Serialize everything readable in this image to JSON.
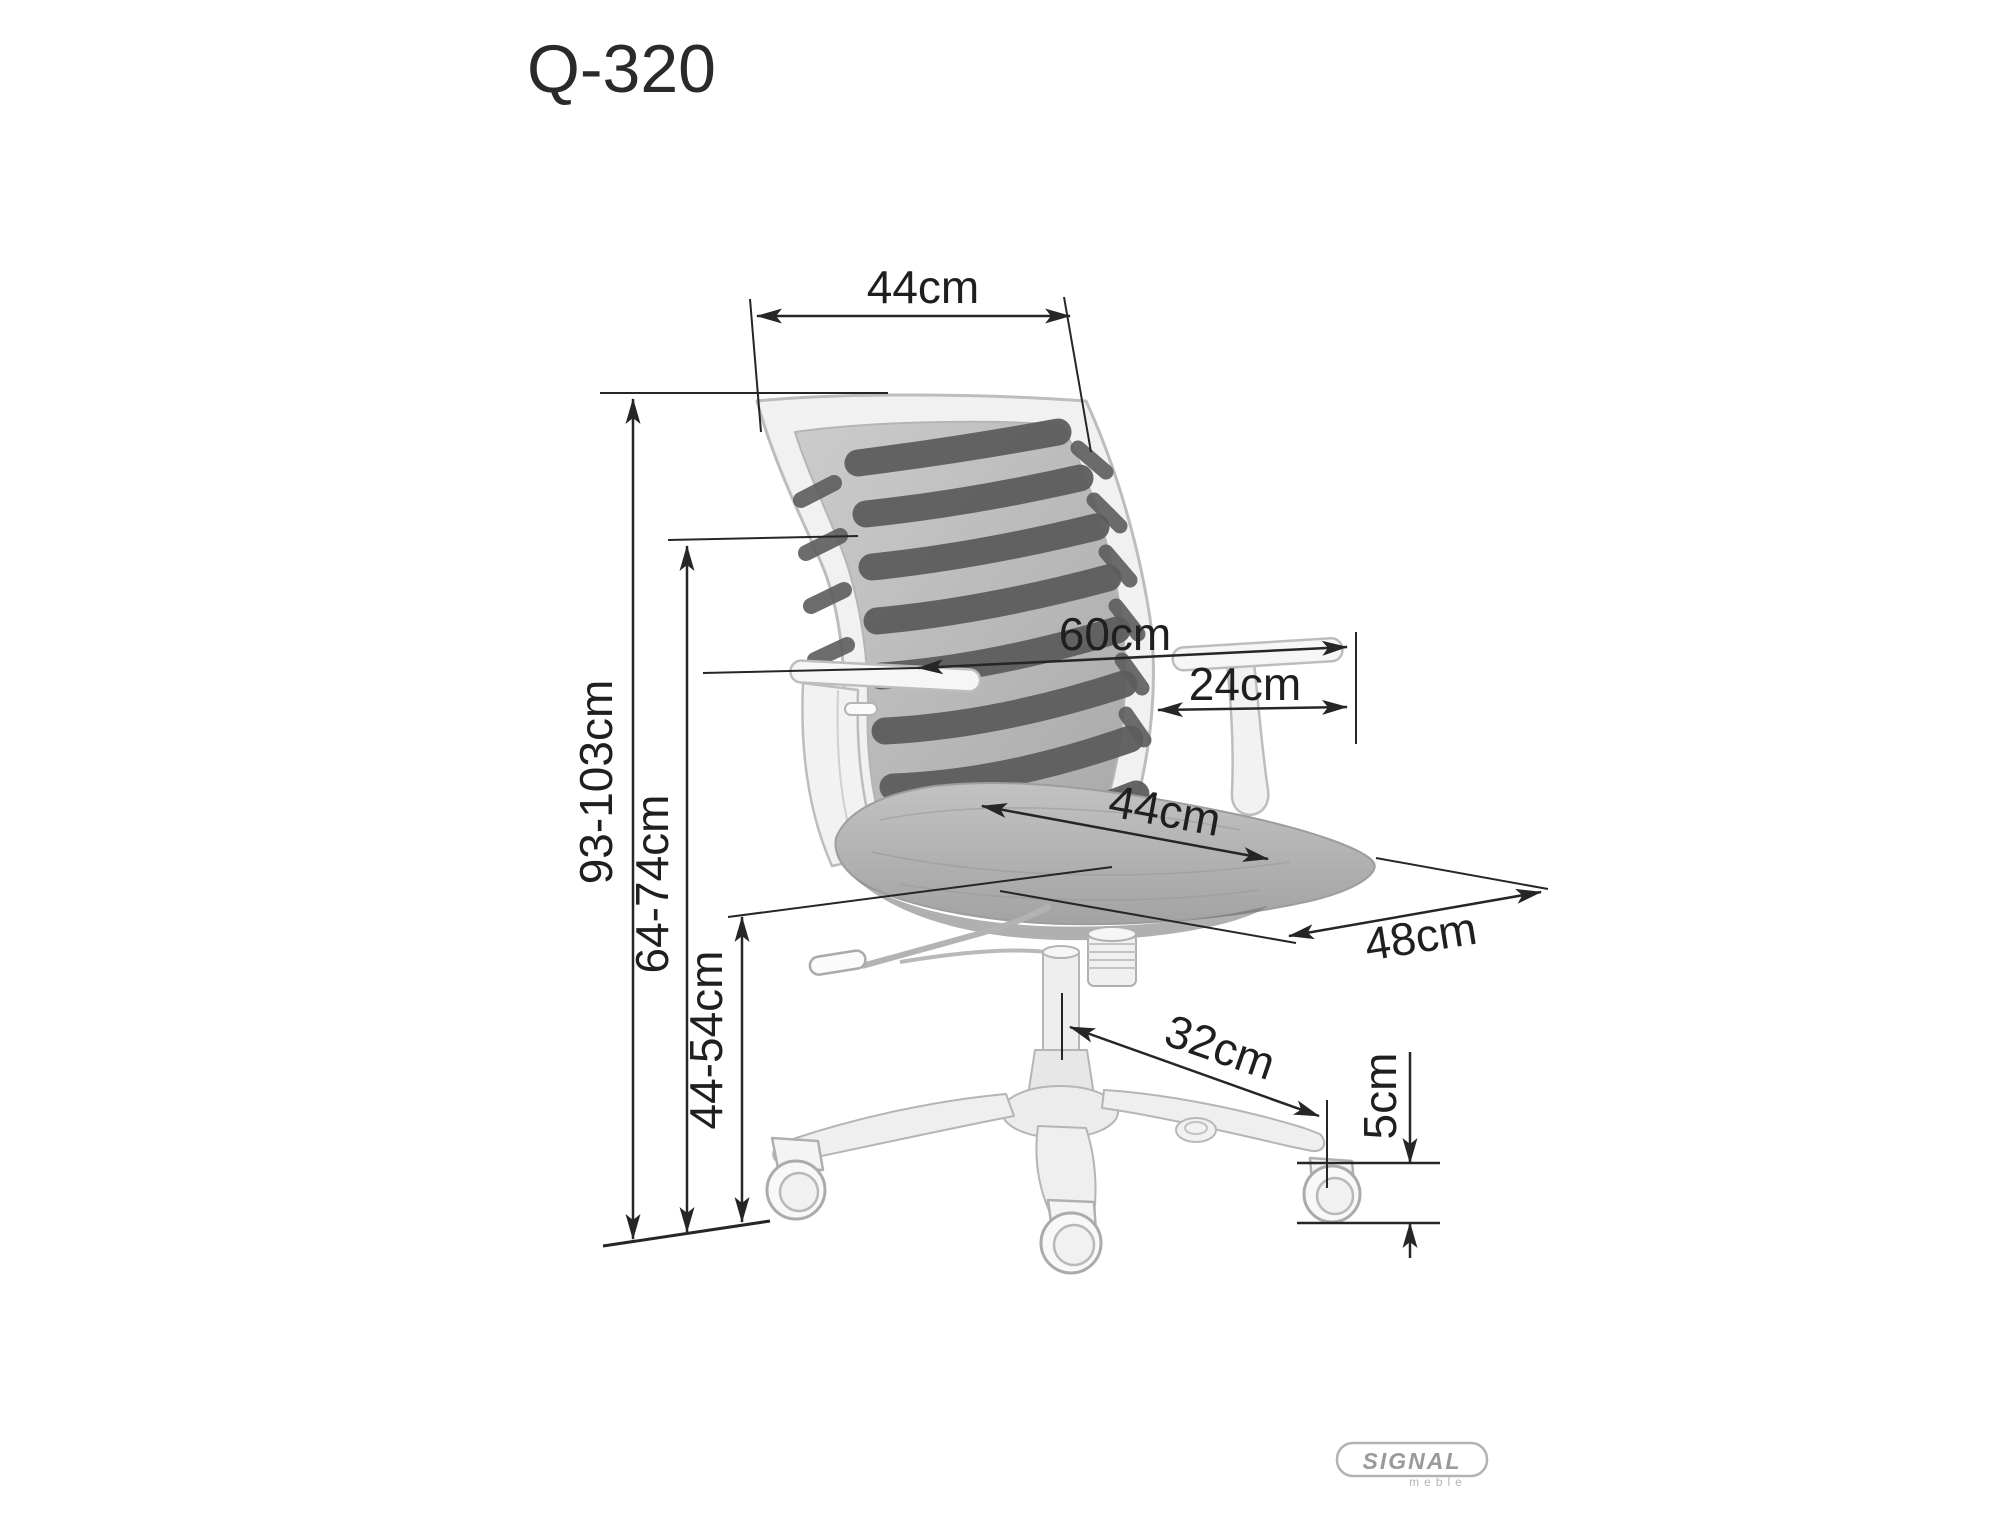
{
  "title": "Q-320",
  "dimensions": {
    "backrest_width": "44cm",
    "total_height": "93-103cm",
    "armrest_height": "64-74cm",
    "seat_height": "44-54cm",
    "overall_width": "60cm",
    "armrest_pad_length": "24cm",
    "seat_width": "44cm",
    "seat_depth": "48cm",
    "base_leg_span": "32cm",
    "caster_diameter": "5cm"
  },
  "logo": {
    "brand": "SIGNAL",
    "subtitle": "meble"
  },
  "colors": {
    "dimension_line": "#262626",
    "chair_outline": "#bdbdbd",
    "chair_fill": "#f2f2f2",
    "mesh_background": "#bcbcbc",
    "mesh_stripe": "#5d5d5d",
    "seat_fill": "#b4b4b4",
    "logo_gray": "#9a9a9a"
  }
}
